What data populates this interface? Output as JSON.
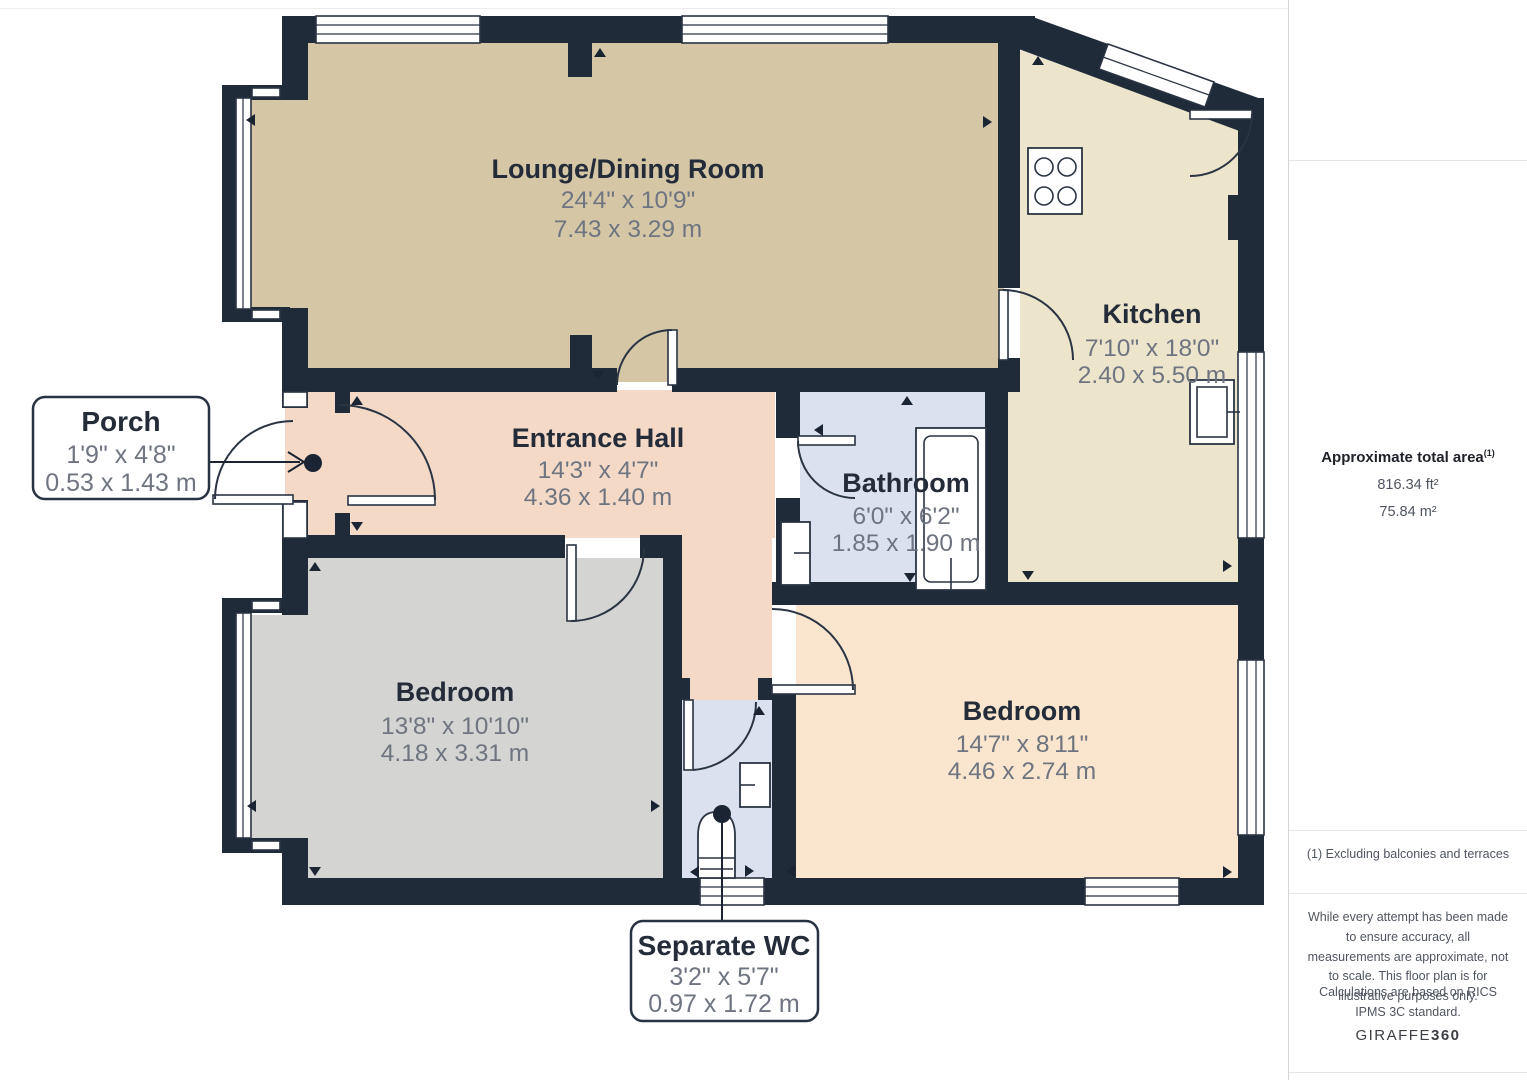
{
  "branding": {
    "name": "PAUL BIRTLES",
    "tagline": "SALES  •  RENTALS  •  MANAGEMENT",
    "navy": "#2e3b8e"
  },
  "sidebar": {
    "area_title": "Approximate total area",
    "area_sup": "(1)",
    "area_ft2": "816.34 ft²",
    "area_m2": "75.84 m²",
    "footnote": "(1) Excluding balconies and terraces",
    "disclaimer": "While every attempt has been made to ensure accuracy, all measurements are approximate, not to scale. This floor plan is for illustrative purposes only.",
    "standard": "Calculations are based on RICS IPMS 3C standard.",
    "brand": "GIRAFFE",
    "brand_bold": "360"
  },
  "rooms": {
    "lounge": {
      "name": "Lounge/Dining Room",
      "imperial": "24'4\" x 10'9\"",
      "metric": "7.43 x 3.29 m"
    },
    "kitchen": {
      "name": "Kitchen",
      "imperial": "7'10\" x 18'0\"",
      "metric": "2.40 x 5.50 m"
    },
    "hall": {
      "name": "Entrance Hall",
      "imperial": "14'3\" x 4'7\"",
      "metric": "4.36 x 1.40 m"
    },
    "bathroom": {
      "name": "Bathroom",
      "imperial": "6'0\" x 6'2\"",
      "metric": "1.85 x 1.90 m"
    },
    "bedroom_left": {
      "name": "Bedroom",
      "imperial": "13'8\" x 10'10\"",
      "metric": "4.18 x 3.31 m"
    },
    "bedroom_right": {
      "name": "Bedroom",
      "imperial": "14'7\" x 8'11\"",
      "metric": "4.46 x 2.74 m"
    },
    "porch": {
      "name": "Porch",
      "imperial": "1'9\" x 4'8\"",
      "metric": "0.53 x 1.43 m"
    },
    "wc": {
      "name": "Separate WC",
      "imperial": "3'2\" x 5'7\"",
      "metric": "0.97 x 1.72 m"
    }
  },
  "colors": {
    "wall": "#202b3a",
    "lounge_floor": "#d5c6a6",
    "kitchen_floor": "#ede5cb",
    "hall_floor": "#f4d9c7",
    "bath_floor": "#dbe1ee",
    "bedroom_left_floor": "#d4d4d3",
    "bedroom_right_floor": "#fae6ce"
  }
}
